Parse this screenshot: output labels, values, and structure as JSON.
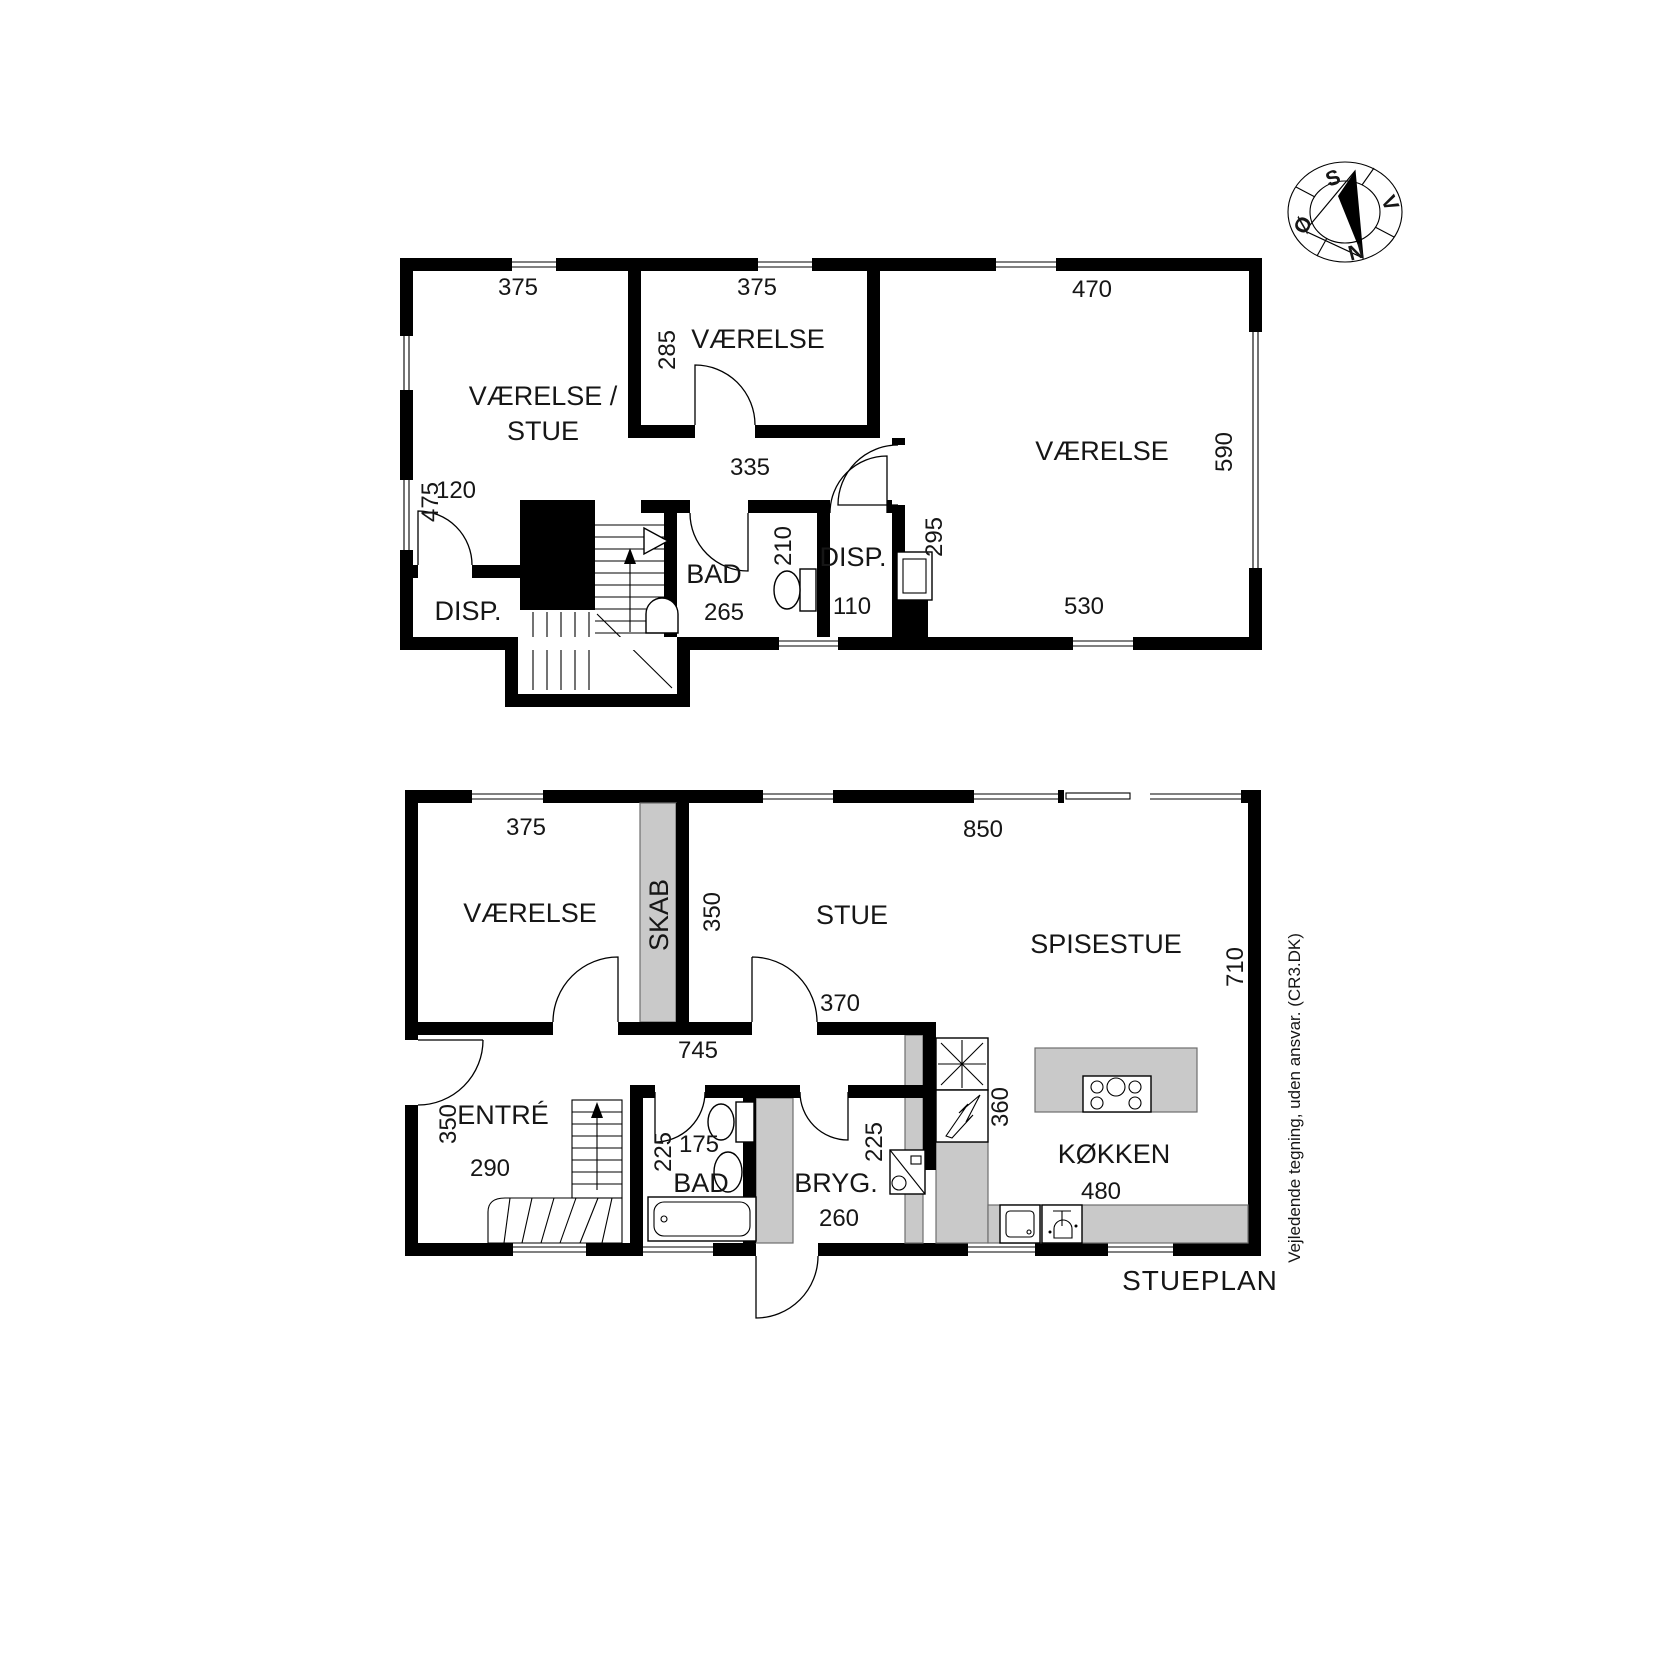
{
  "plan_label": "STUEPLAN",
  "disclaimer": "Vejledende tegning, uden ansvar. (CR3.DK)",
  "compass": {
    "n": "N",
    "s": "S",
    "v": "V",
    "o": "Ø"
  },
  "upper": {
    "room_vaerelse_stue_line1": "VÆRELSE /",
    "room_vaerelse_stue_line2": "STUE",
    "room_vaerelse_mid": "VÆRELSE",
    "room_vaerelse_right": "VÆRELSE",
    "room_bad": "BAD",
    "room_disp_left": "DISP.",
    "room_disp_right": "DISP.",
    "dim_375_left": "375",
    "dim_375_mid": "375",
    "dim_470": "470",
    "dim_475": "475",
    "dim_285": "285",
    "dim_335": "335",
    "dim_590": "590",
    "dim_120": "120",
    "dim_210": "210",
    "dim_295": "295",
    "dim_265": "265",
    "dim_110": "110",
    "dim_530": "530"
  },
  "lower": {
    "room_vaerelse": "VÆRELSE",
    "room_skab": "SKAB",
    "room_stue": "STUE",
    "room_spisestue": "SPISESTUE",
    "room_entre": "ENTRÉ",
    "room_bad": "BAD",
    "room_bryg": "BRYG.",
    "room_kokken": "KØKKEN",
    "dim_375": "375",
    "dim_850": "850",
    "dim_350_skab": "350",
    "dim_710": "710",
    "dim_370": "370",
    "dim_745": "745",
    "dim_350_entre": "350",
    "dim_290": "290",
    "dim_225_bad": "225",
    "dim_175": "175",
    "dim_225_bryg": "225",
    "dim_360": "360",
    "dim_260": "260",
    "dim_480": "480"
  },
  "colors": {
    "wall": "#000000",
    "fill_gray": "#c9c9c9",
    "background": "#ffffff"
  }
}
